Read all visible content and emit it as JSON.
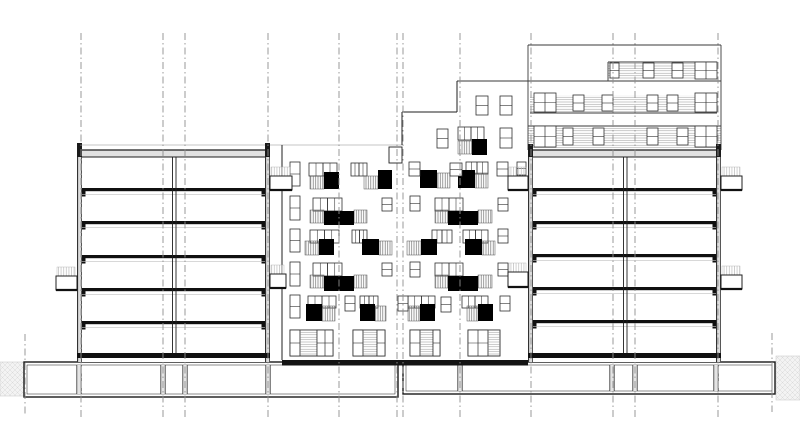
{
  "canvas": {
    "w": 800,
    "h": 446,
    "bg": "#ffffff"
  },
  "palette": {
    "line": "#1f1f1f",
    "slab": "#101010",
    "wall_fill": "#dcdcdc",
    "roof_fill": "#e2e2e2",
    "light_line": "#c6c6c6",
    "ceiling_line": "#c2c2c2",
    "grid": "#8f8f8f",
    "hatch_dark": "#6f6f6f",
    "hatch_light": "#bdbdbd",
    "hatch_horiz": "#9d9d9d",
    "earth_bg": "#f3f3f3",
    "earth_line": "#dadada",
    "window_stroke": "#2f2f2f",
    "black": "#000000"
  },
  "grid_lines": [
    {
      "x": 25,
      "y1": 334,
      "y2": 414
    },
    {
      "x": 81,
      "y1": 33,
      "y2": 417
    },
    {
      "x": 163,
      "y1": 33,
      "y2": 417
    },
    {
      "x": 185,
      "y1": 33,
      "y2": 417
    },
    {
      "x": 268,
      "y1": 33,
      "y2": 417
    },
    {
      "x": 339,
      "y1": 33,
      "y2": 417
    },
    {
      "x": 397,
      "y1": 33,
      "y2": 417
    },
    {
      "x": 403,
      "y1": 33,
      "y2": 417
    },
    {
      "x": 460,
      "y1": 33,
      "y2": 417
    },
    {
      "x": 531,
      "y1": 33,
      "y2": 417
    },
    {
      "x": 613,
      "y1": 33,
      "y2": 417
    },
    {
      "x": 635,
      "y1": 33,
      "y2": 417
    },
    {
      "x": 718,
      "y1": 33,
      "y2": 417
    },
    {
      "x": 772,
      "y1": 333,
      "y2": 412
    }
  ],
  "terrain": [
    [
      0,
      362,
      24,
      34
    ],
    [
      776,
      356,
      24,
      44
    ]
  ],
  "background_building": {
    "light_roofline": [
      81,
      145,
      402,
      145
    ],
    "lines": [
      [
        528,
        45,
        721,
        45
      ],
      [
        528,
        45,
        528,
        150
      ],
      [
        721,
        45,
        721,
        150
      ],
      [
        457,
        81,
        721,
        81
      ],
      [
        530,
        113,
        717,
        113
      ],
      [
        528,
        126,
        721,
        126
      ],
      [
        608,
        62,
        717,
        62
      ],
      [
        608,
        62,
        608,
        81
      ]
    ],
    "hatch_bands": [
      [
        608,
        63,
        109,
        17
      ],
      [
        530,
        95,
        187,
        18
      ],
      [
        528,
        127,
        193,
        22
      ]
    ],
    "windows": [
      {
        "t": "w1",
        "r": [
          610,
          63,
          9,
          15
        ]
      },
      {
        "t": "w1",
        "r": [
          643,
          63,
          11,
          15
        ]
      },
      {
        "t": "w1",
        "r": [
          672,
          63,
          11,
          15
        ]
      },
      {
        "t": "p4",
        "r": [
          695,
          62,
          22,
          17
        ]
      },
      {
        "t": "p4",
        "r": [
          534,
          93,
          22,
          19
        ]
      },
      {
        "t": "w1",
        "r": [
          573,
          95,
          11,
          16
        ]
      },
      {
        "t": "w1",
        "r": [
          602,
          95,
          11,
          16
        ]
      },
      {
        "t": "w1",
        "r": [
          647,
          95,
          11,
          16
        ]
      },
      {
        "t": "w1",
        "r": [
          667,
          95,
          11,
          16
        ]
      },
      {
        "t": "p4",
        "r": [
          695,
          93,
          22,
          19
        ]
      },
      {
        "t": "p4",
        "r": [
          534,
          126,
          22,
          21
        ]
      },
      {
        "t": "w1",
        "r": [
          563,
          128,
          10,
          17
        ]
      },
      {
        "t": "w1",
        "r": [
          593,
          128,
          11,
          17
        ]
      },
      {
        "t": "w1",
        "r": [
          647,
          128,
          11,
          17
        ]
      },
      {
        "t": "w1",
        "r": [
          677,
          128,
          11,
          17
        ]
      },
      {
        "t": "p4",
        "r": [
          695,
          126,
          22,
          21
        ]
      }
    ]
  },
  "middle_facade": {
    "steps": [
      {
        "x1": 282,
        "x2": 402,
        "top": 145
      },
      {
        "x1": 402,
        "x2": 457,
        "top": 112
      },
      {
        "x1": 457,
        "x2": 528,
        "top": 81
      }
    ],
    "outline": [
      [
        282,
        145,
        282,
        360
      ],
      [
        402,
        112,
        402,
        145
      ],
      [
        402,
        112,
        457,
        112
      ],
      [
        457,
        81,
        457,
        112
      ]
    ],
    "roof_box": [
      389,
      147,
      13,
      16
    ],
    "bottom_band": [
      282,
      360,
      246,
      5.5
    ],
    "windows_single": [
      [
        290,
        162,
        10,
        24
      ],
      [
        290,
        196,
        10,
        24
      ],
      [
        290,
        229,
        10,
        23
      ],
      [
        290,
        262,
        10,
        24
      ],
      [
        290,
        295,
        10,
        23
      ],
      [
        382,
        198,
        10,
        13
      ],
      [
        382,
        263,
        10,
        13
      ],
      [
        345,
        296,
        10,
        15
      ],
      [
        398,
        296,
        10,
        15
      ],
      [
        441,
        297,
        10,
        15
      ],
      [
        409,
        162,
        11,
        14
      ],
      [
        450,
        163,
        12,
        13
      ],
      [
        497,
        162,
        11,
        14
      ],
      [
        517,
        162,
        9,
        13
      ],
      [
        410,
        196,
        10,
        15
      ],
      [
        498,
        198,
        10,
        13
      ],
      [
        498,
        229,
        10,
        14
      ],
      [
        410,
        262,
        10,
        15
      ],
      [
        498,
        263,
        10,
        13
      ],
      [
        500,
        296,
        10,
        15
      ],
      [
        437,
        129,
        11,
        19
      ],
      [
        500,
        128,
        12,
        20
      ],
      [
        476,
        96,
        12,
        19
      ],
      [
        500,
        96,
        12,
        19
      ]
    ],
    "window_pairs": [
      [
        309,
        163,
        28,
        13
      ],
      [
        351,
        163,
        16,
        13
      ],
      [
        466,
        162,
        22,
        12
      ],
      [
        313,
        198,
        29,
        13
      ],
      [
        435,
        198,
        28,
        13
      ],
      [
        310,
        230,
        29,
        13
      ],
      [
        352,
        230,
        15,
        13
      ],
      [
        432,
        230,
        20,
        13
      ],
      [
        463,
        230,
        25,
        13
      ],
      [
        313,
        263,
        29,
        13
      ],
      [
        435,
        263,
        28,
        13
      ],
      [
        308,
        296,
        28,
        12
      ],
      [
        360,
        296,
        18,
        12
      ],
      [
        408,
        296,
        27,
        12
      ],
      [
        462,
        296,
        26,
        12
      ],
      [
        458,
        127,
        26,
        13
      ]
    ],
    "railings": [
      [
        310,
        176,
        14,
        13
      ],
      [
        364,
        176,
        14,
        13
      ],
      [
        437,
        173,
        13,
        15
      ],
      [
        475,
        173,
        13,
        15
      ],
      [
        310,
        210,
        14,
        13
      ],
      [
        354,
        210,
        13,
        13
      ],
      [
        435,
        210,
        13,
        13
      ],
      [
        478,
        210,
        14,
        13
      ],
      [
        305,
        241,
        14,
        14
      ],
      [
        379,
        241,
        13,
        14
      ],
      [
        407,
        241,
        14,
        14
      ],
      [
        482,
        241,
        13,
        14
      ],
      [
        310,
        275,
        14,
        13
      ],
      [
        354,
        275,
        13,
        13
      ],
      [
        435,
        275,
        13,
        13
      ],
      [
        478,
        275,
        14,
        13
      ],
      [
        322,
        306,
        13,
        15
      ],
      [
        375,
        306,
        11,
        15
      ],
      [
        408,
        306,
        12,
        15
      ],
      [
        467,
        306,
        11,
        15
      ],
      [
        458,
        141,
        14,
        13
      ]
    ],
    "black_panels": [
      [
        324,
        172,
        15,
        17
      ],
      [
        378,
        170,
        14,
        19
      ],
      [
        420,
        170,
        17,
        18
      ],
      [
        458,
        170,
        17,
        18
      ],
      [
        324,
        211,
        30,
        14
      ],
      [
        448,
        211,
        30,
        14
      ],
      [
        319,
        239,
        15,
        16
      ],
      [
        362,
        239,
        17,
        16
      ],
      [
        421,
        239,
        16,
        16
      ],
      [
        465,
        239,
        17,
        16
      ],
      [
        324,
        276,
        30,
        15
      ],
      [
        448,
        276,
        30,
        15
      ],
      [
        306,
        304,
        16,
        17
      ],
      [
        360,
        304,
        15,
        17
      ],
      [
        420,
        304,
        15,
        17
      ],
      [
        478,
        304,
        15,
        17
      ],
      [
        472,
        139,
        15,
        16
      ]
    ],
    "ground_units": [
      {
        "x": 290,
        "y": 330,
        "h": 26,
        "cells": [
          [
            "w2",
            10
          ],
          [
            "hh",
            17
          ],
          [
            "w4",
            16
          ]
        ]
      },
      {
        "x": 353,
        "y": 330,
        "h": 26,
        "cells": [
          [
            "w2",
            10
          ],
          [
            "hh",
            14
          ],
          [
            "w2",
            8
          ]
        ]
      },
      {
        "x": 410,
        "y": 330,
        "h": 26,
        "cells": [
          [
            "w2",
            10
          ],
          [
            "hh",
            13
          ],
          [
            "w2",
            7
          ]
        ]
      },
      {
        "x": 468,
        "y": 330,
        "h": 26,
        "cells": [
          [
            "w4",
            20
          ],
          [
            "hh",
            12
          ]
        ]
      }
    ]
  },
  "buildings": [
    {
      "name": "left-section-building",
      "x": 77,
      "w": 193,
      "mid_wall": 172,
      "parapet_y": 143,
      "roof_top": 150,
      "floors": [
        188,
        221,
        255,
        288,
        321
      ],
      "ground_slab_y": 353,
      "bottom": 362
    },
    {
      "name": "right-section-building",
      "x": 528,
      "w": 193,
      "mid_wall": 623,
      "parapet_y": 144,
      "roof_top": 150,
      "floors": [
        188,
        221,
        254,
        287,
        320
      ],
      "ground_slab_y": 353,
      "bottom": 362
    }
  ],
  "balconies": [
    [
      270,
      176,
      22,
      14
    ],
    [
      270,
      274,
      16,
      14
    ],
    [
      56,
      276,
      21,
      14
    ],
    [
      508,
      176,
      20,
      14
    ],
    [
      508,
      272,
      20,
      15
    ],
    [
      721,
      176,
      21,
      14
    ],
    [
      721,
      275,
      21,
      14
    ]
  ],
  "basement": {
    "boxes": [
      [
        24,
        362,
        374,
        35
      ],
      [
        403,
        362,
        372,
        32
      ]
    ],
    "dividers": [
      [
        79,
        163,
        185,
        268
      ],
      [
        460,
        612,
        635,
        716
      ]
    ]
  }
}
